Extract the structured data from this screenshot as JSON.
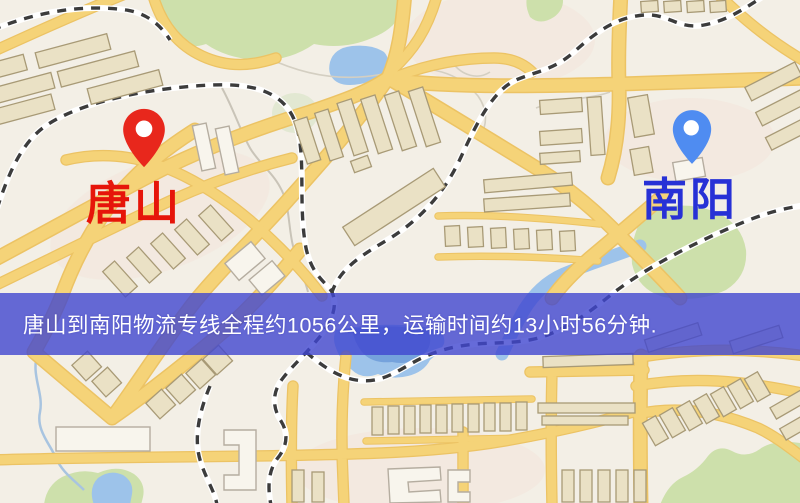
{
  "banner": {
    "text": "唐山到南阳物流专线全程约1056公里，运输时间约13小时56分钟.",
    "background": "#4046cf",
    "text_color": "#ffffff"
  },
  "map": {
    "markers": {
      "origin": {
        "label": "唐山",
        "label_color": "#e6150a",
        "pin_color": "#e8271c"
      },
      "destination": {
        "label": "南阳",
        "label_color": "#2731d6",
        "pin_color": "#4f8cf1"
      }
    },
    "colors": {
      "background": "#f3efe6",
      "tint": "#f3e2d6",
      "park": "#cde0ab",
      "park_light": "#e2e8d2",
      "water": "#9dc3ea",
      "water_deep": "#6f9cd9",
      "road": "#f5d378",
      "road_casing": "#ecc364",
      "building": "#eae1c5",
      "building_stroke": "#a89a76",
      "building_light": "#f8f5ed",
      "building_light_stroke": "#b5ada0",
      "railway_dash": "#3c3c3c",
      "railway_casing": "#ffffff",
      "footpath": "#c9c4b8",
      "stream": "#a8c4e0",
      "contour": "#d4cfc2"
    }
  }
}
